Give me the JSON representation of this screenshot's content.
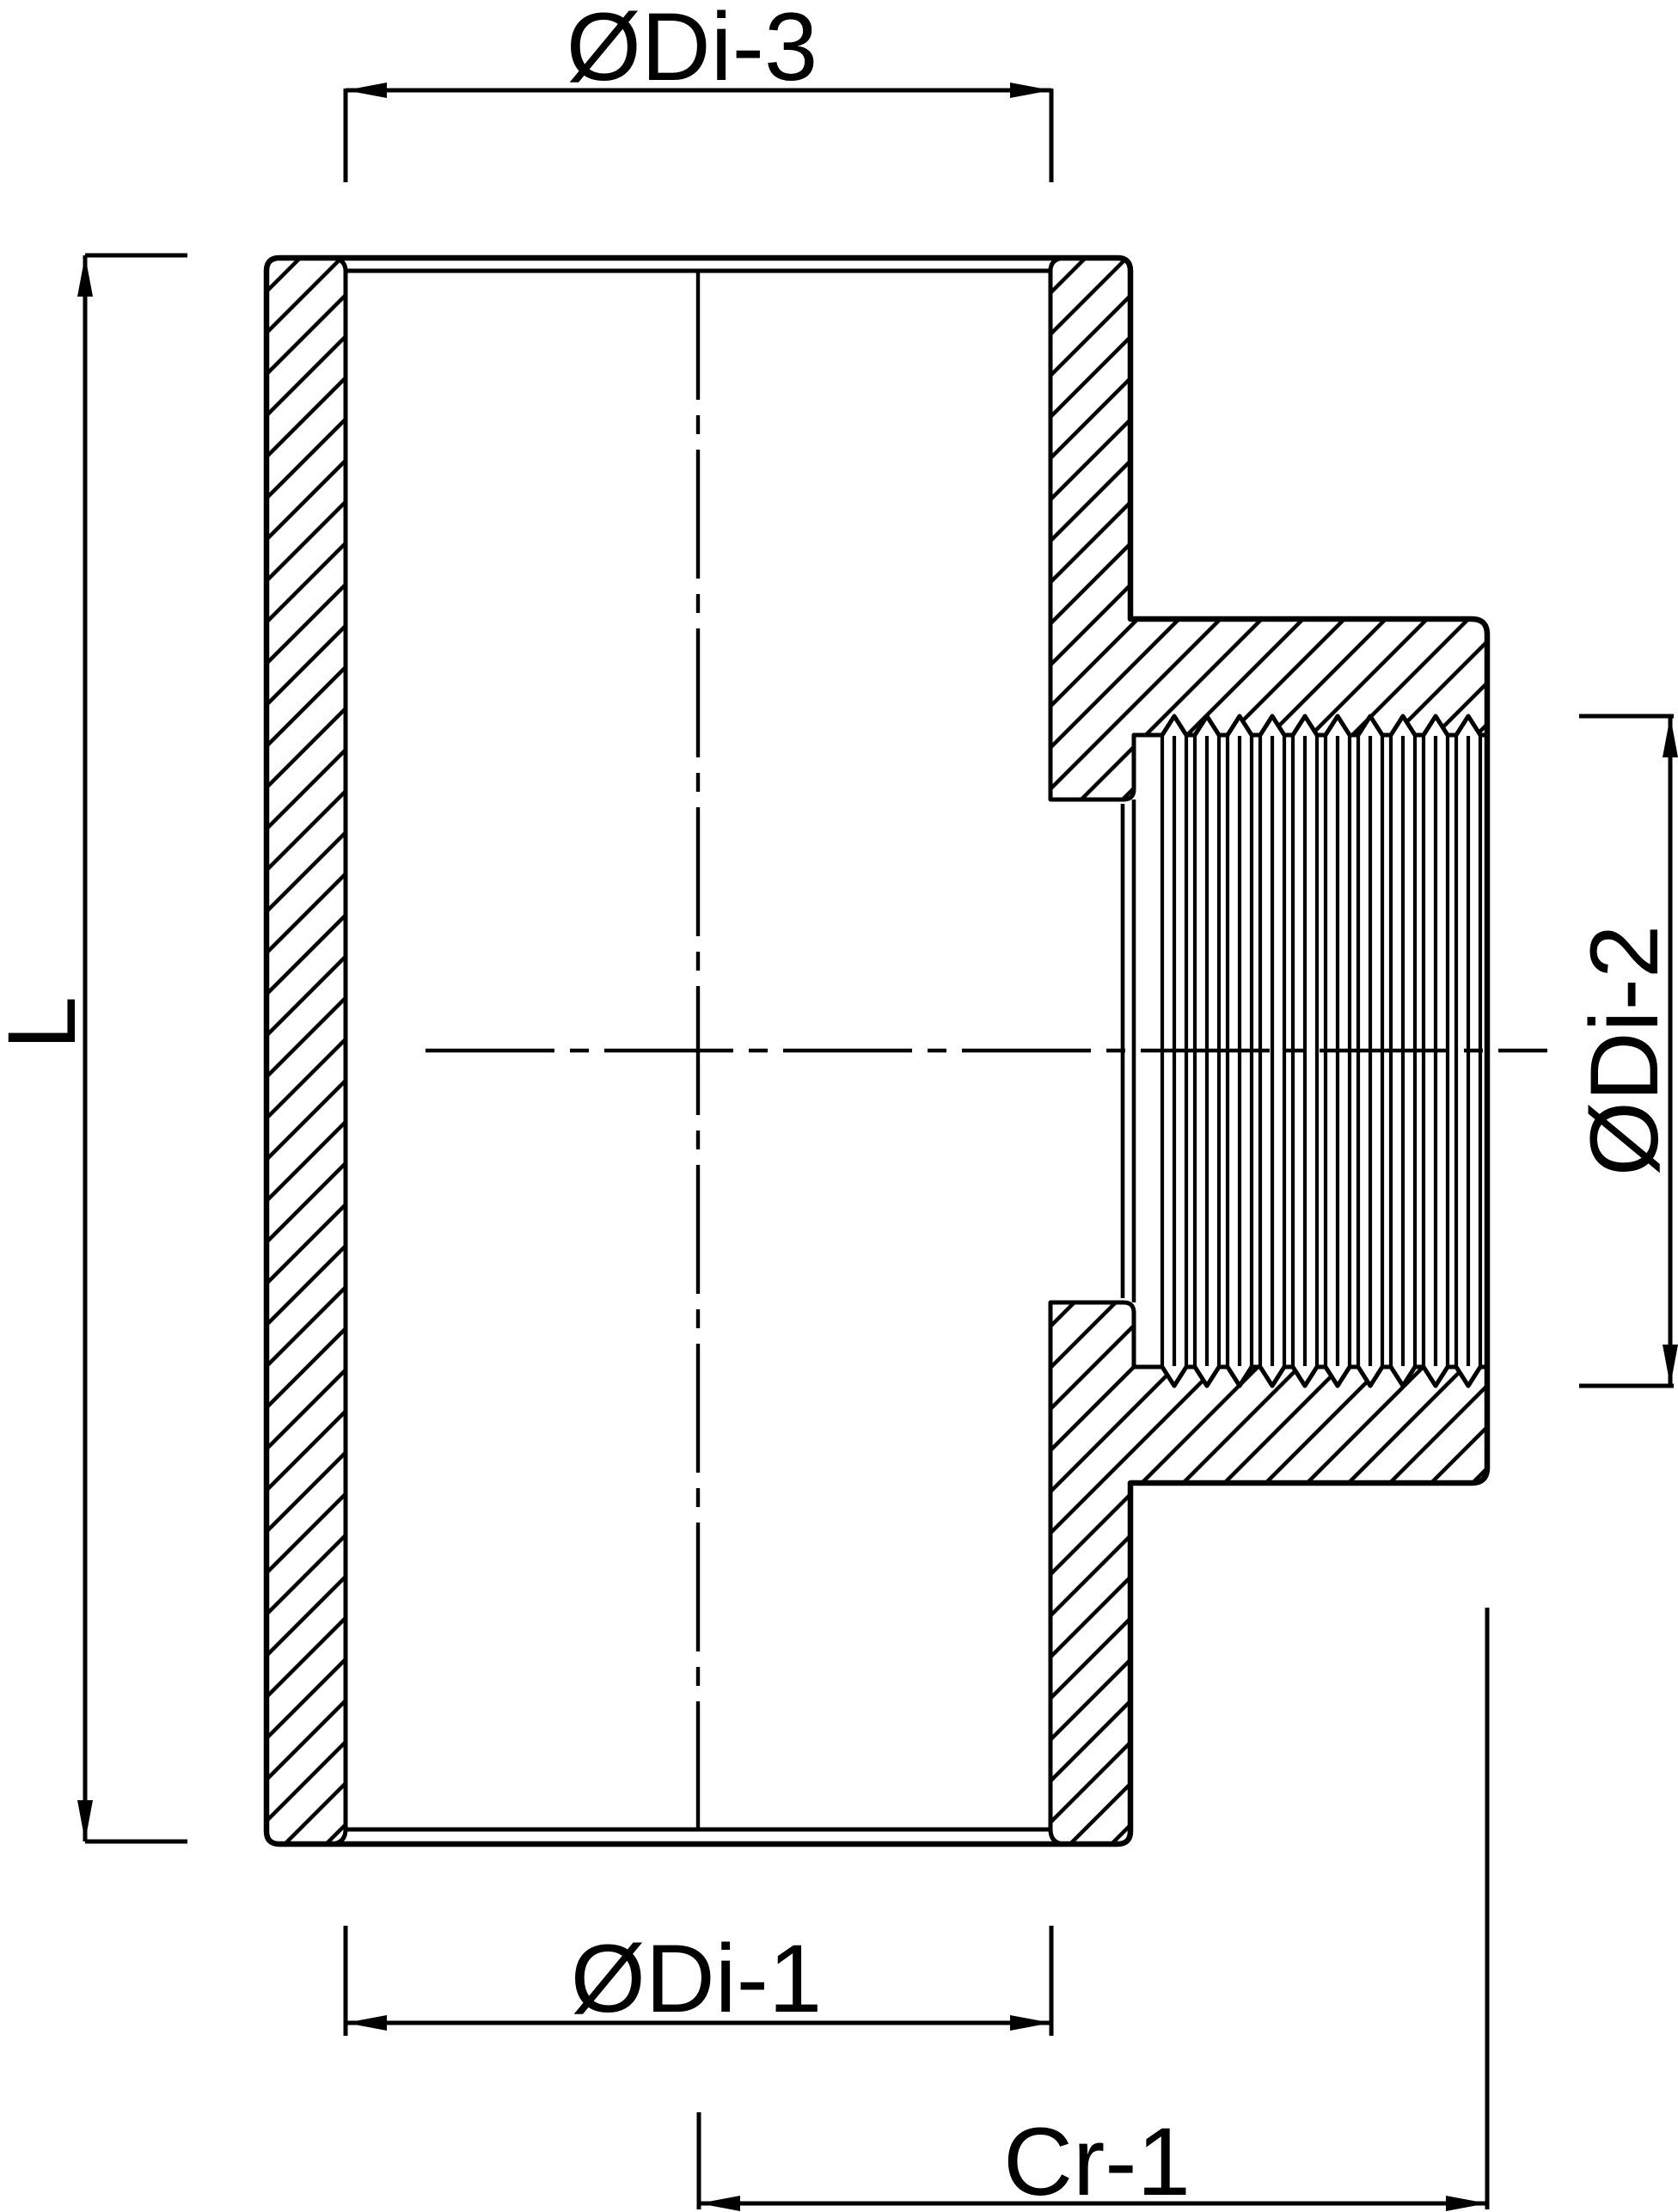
{
  "drawing": {
    "labels": {
      "top_inner_diameter": "ØDi-3",
      "body_length": "L",
      "branch_inner_diameter": "ØDi-2",
      "bottom_inner_diameter": "ØDi-1",
      "branch_center_to_face": "Cr-1"
    },
    "colors": {
      "line": "#000000",
      "background": "#ffffff"
    }
  }
}
